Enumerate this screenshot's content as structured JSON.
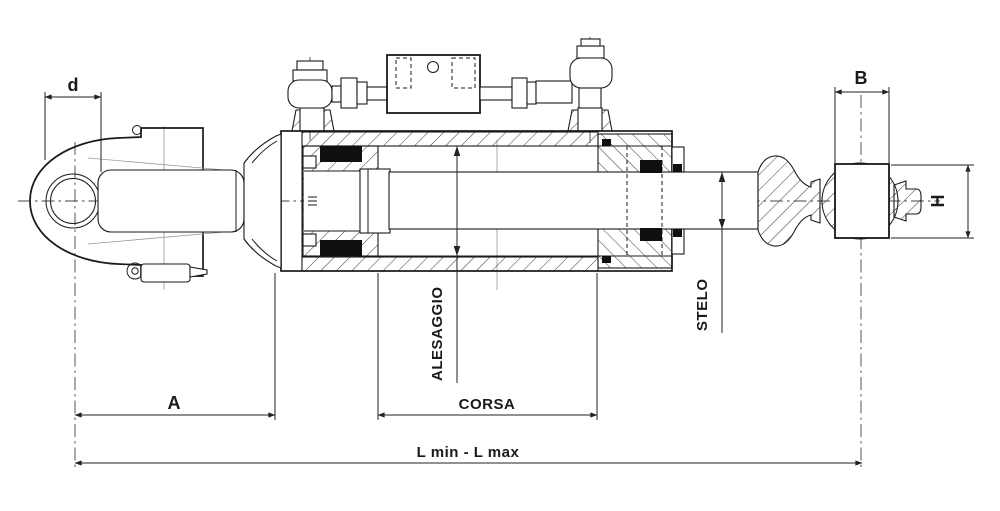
{
  "drawing": {
    "background": "#ffffff",
    "ink_color": "#1a1a1a",
    "dimension_color": "#222222",
    "labels": {
      "pin_diameter": "d",
      "ball_width": "B",
      "ball_height": "H",
      "front_length": "A",
      "stroke": "CORSA",
      "bore": "ALESAGGIO",
      "rod": "STELO",
      "overall_length": "L min - L max"
    }
  }
}
